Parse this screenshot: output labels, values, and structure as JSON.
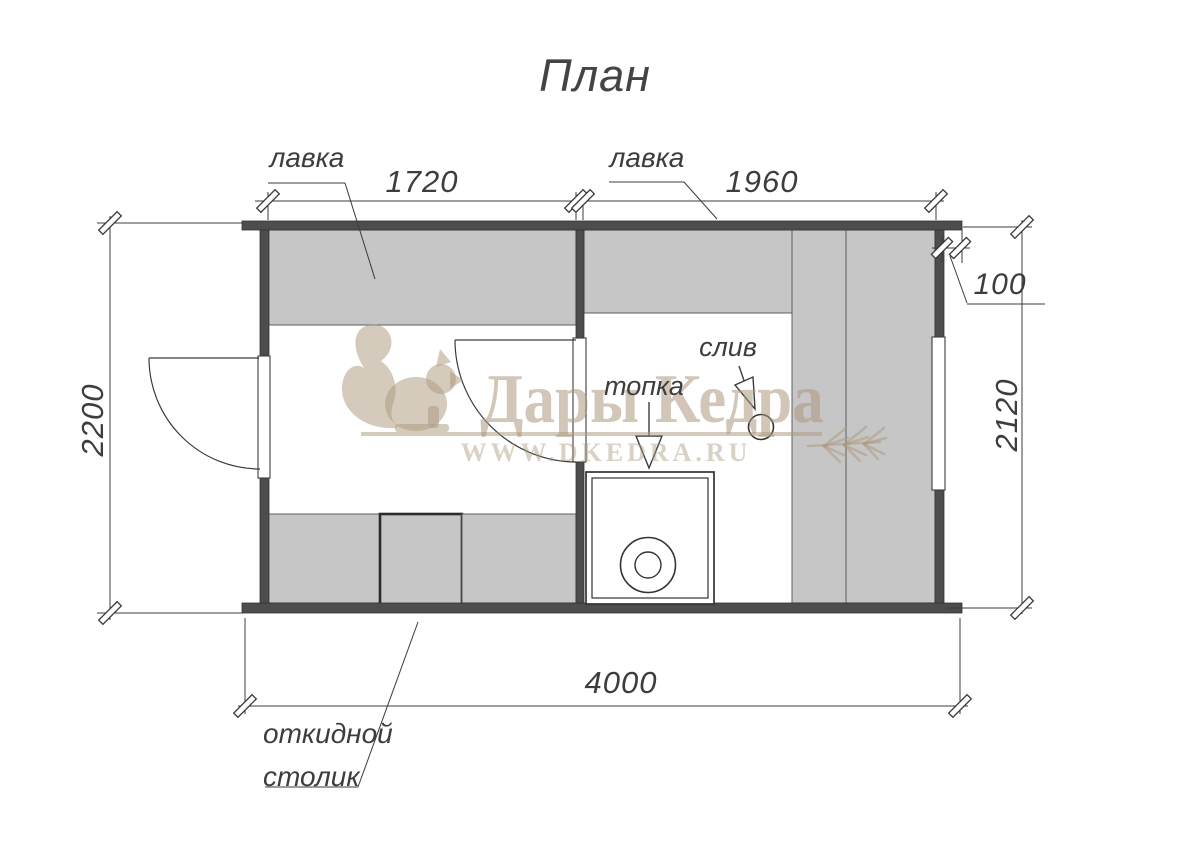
{
  "title": "План",
  "watermark": {
    "brand": "Дары Кедра",
    "url": "WWW.DKEDRA.RU"
  },
  "labels": {
    "bench_left": "лавка",
    "bench_right": "лавка",
    "stove": "топка",
    "drain": "слив",
    "folding_table_line1": "откидной",
    "folding_table_line2": "столик"
  },
  "dimensions": {
    "room1_width": "1720",
    "room2_width": "1960",
    "wall_offset": "100",
    "left_height": "2200",
    "right_height": "2120",
    "total_width": "4000"
  },
  "colors": {
    "wall": "#4d4d4d",
    "bench": "#c6c6c6",
    "line": "#3c3c3c",
    "watermark": "#ab987c",
    "background": "#ffffff"
  }
}
